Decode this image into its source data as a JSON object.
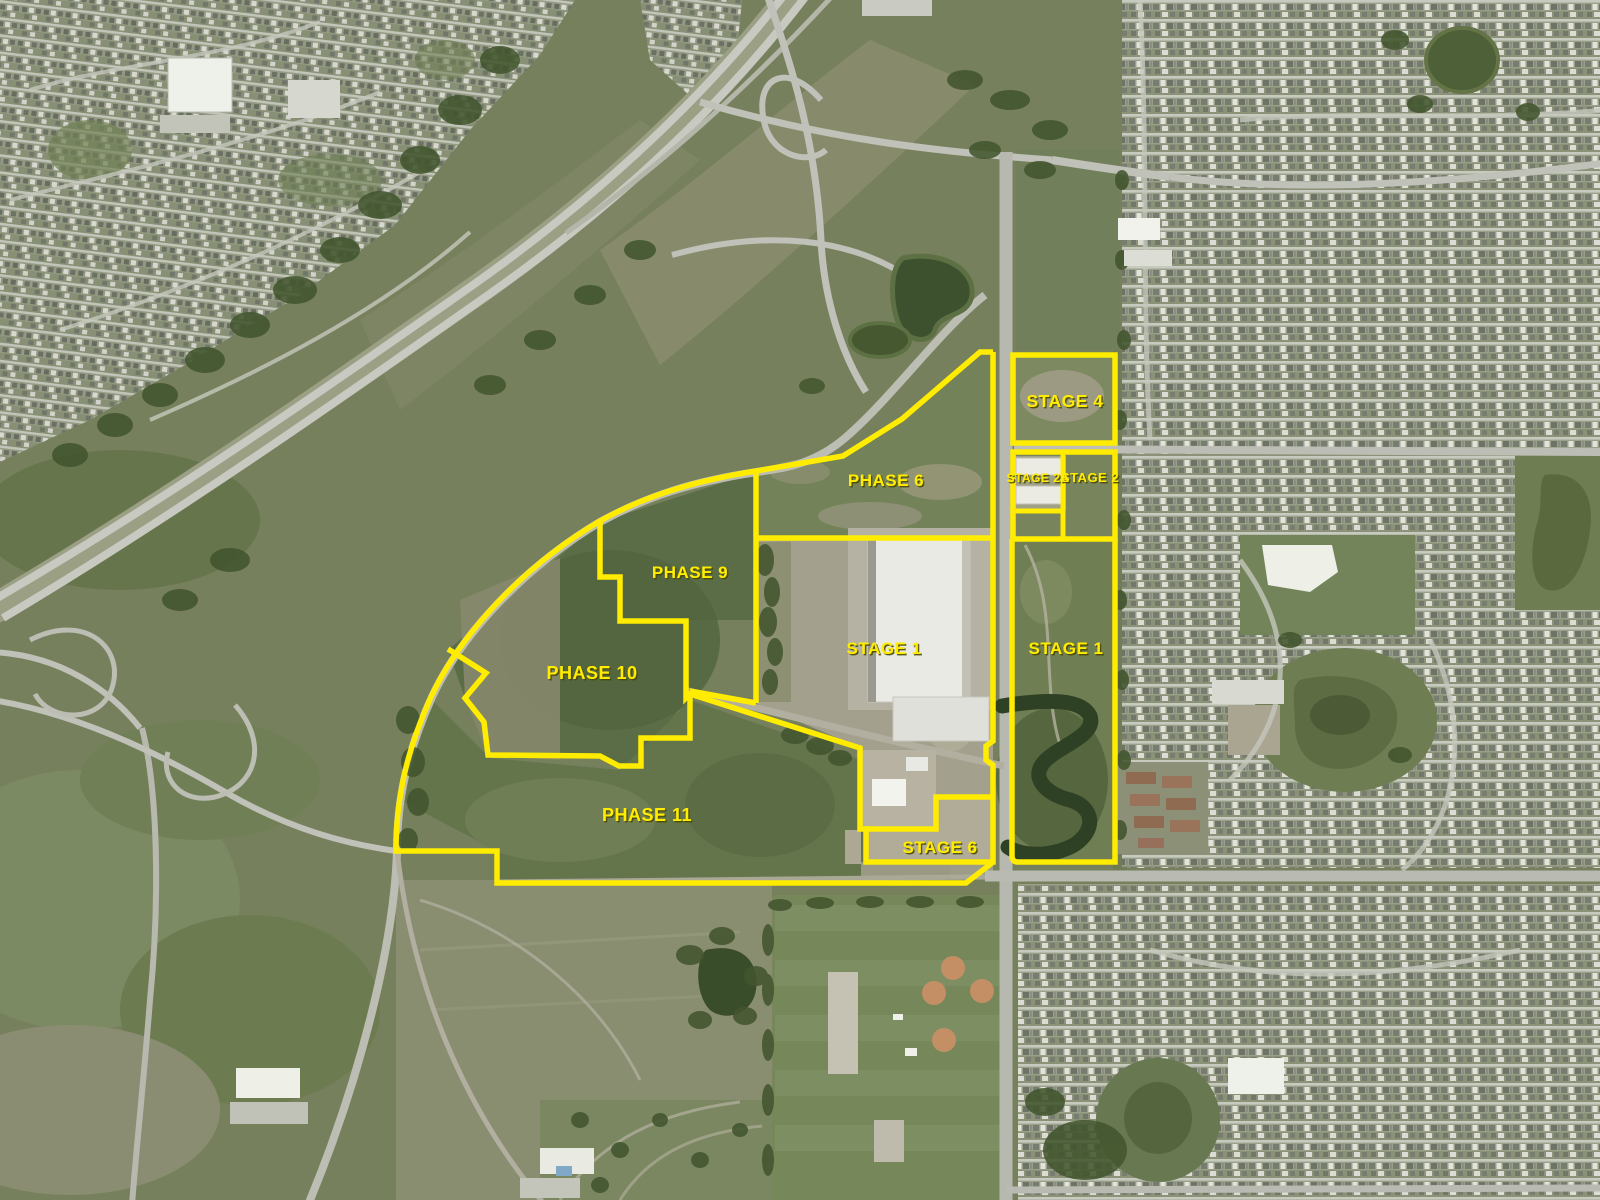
{
  "map": {
    "description": "Aerial photo with land development phase overlay",
    "overlay_color": "#ffec00",
    "label_color": "#ffec00",
    "labels": {
      "phase6": {
        "text": "PHASE 6"
      },
      "phase9": {
        "text": "PHASE 9"
      },
      "phase10": {
        "text": "PHASE 10"
      },
      "phase11": {
        "text": "PHASE 11"
      },
      "stage1w": {
        "text": "STAGE 1"
      },
      "stage1e": {
        "text": "STAGE 1"
      },
      "stage2a": {
        "text": "STAGE 2A"
      },
      "stage2": {
        "text": "STAGE 2"
      },
      "stage4": {
        "text": "STAGE 4"
      },
      "stage6": {
        "text": "STAGE 6"
      }
    }
  }
}
